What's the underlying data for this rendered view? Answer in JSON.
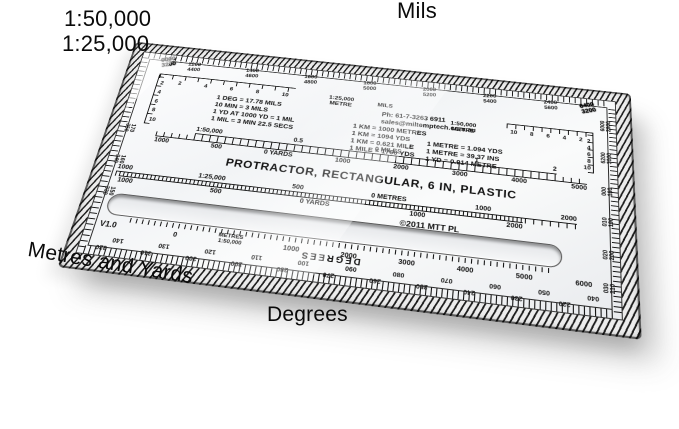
{
  "annotations": {
    "scale_50k": "1:50,000",
    "scale_25k": "1:25,000",
    "mils": "Mils",
    "metres_and_yards": "Metres and Yards",
    "degrees": "Degrees"
  },
  "board": {
    "title": "PROTRACTOR, RECTANGULAR, 6 IN, PLASTIC",
    "copyright": "©2011 MTT PL",
    "version": "V1.0",
    "contact": {
      "phone": "Ph: 61-7-3263 6911",
      "email": "sales@miltemptech.com.au"
    },
    "mils_facts": [
      "1 DEG = 17.78 MILS",
      "10 MIN = 3 MILS",
      "1 YD AT 1000 YD = 1 MIL",
      "1 MIL = 3 MIN 22.5 SECS"
    ],
    "km_facts": [
      "1 KM = 1000 METRES",
      "1 KM = 1094 YDS",
      "1 KM = 0.621 MILE",
      "1 MILE = 1760 YDS"
    ],
    "metre_facts": [
      "1 METRE = 1.094 YDS",
      "1 METRE = 39.37 INS",
      "1 YD = 0.914 METRE"
    ],
    "top_mils_scale": {
      "corner_left": [
        "0000",
        "3200"
      ],
      "corner_right": [
        "6400",
        "3200"
      ],
      "pairs": [
        [
          "1200",
          "4400"
        ],
        [
          "1400",
          "4600"
        ],
        [
          "1600",
          "4800"
        ],
        [
          "1800",
          "5000"
        ],
        [
          "2000",
          "5200"
        ],
        [
          "2200",
          "5400"
        ],
        [
          "2400",
          "5600"
        ]
      ]
    },
    "corner_scale_25k": {
      "label_line1": "1:25,000",
      "label_line2": "METRE",
      "mils_label": "MILS",
      "h_numbers": [
        "2",
        "4",
        "6",
        "8",
        "10"
      ],
      "v_numbers": [
        "2",
        "4",
        "6",
        "8",
        "10"
      ]
    },
    "corner_scale_50k": {
      "label_line1": "1:50,000",
      "label_line2": "METRE",
      "h_numbers": [
        "10",
        "8",
        "6",
        "4",
        "2"
      ],
      "v_numbers": [
        "2",
        "4",
        "6",
        "8",
        "10"
      ]
    },
    "ruler_50k": {
      "miles_row": [
        "1:50,000",
        "0.5",
        "0 MILES",
        "1",
        "2"
      ],
      "yards_row": [
        "1000",
        "500",
        "0 YARDS",
        "1000",
        "2000",
        "3000",
        "4000",
        "5000"
      ]
    },
    "ruler_25k": {
      "metres_row": [
        "1000",
        "1:25,000",
        "500",
        "0 METRES",
        "1000",
        "2000"
      ],
      "yards_row": [
        "1000",
        "500",
        "0 YARDS",
        "1000",
        "2000"
      ]
    },
    "bottom_scale": {
      "items": [
        "0",
        [
          "METRES",
          "1:50,000"
        ],
        "1000",
        "2000",
        "3000",
        "4000",
        "5000",
        "6000"
      ]
    },
    "degrees_label": "DEGREES",
    "bottom_degrees": {
      "outer": [
        "040",
        "050",
        "060",
        "070",
        "080",
        "090",
        "100",
        "110",
        "120",
        "130",
        "140"
      ],
      "inner": [
        "220",
        "230",
        "240",
        "250",
        "260",
        "270",
        "280",
        "290",
        "300",
        "310",
        "320"
      ]
    },
    "left_edge_degrees": [
      [
        "170",
        "350"
      ],
      [
        "160",
        "340"
      ],
      [
        "150",
        "330"
      ]
    ],
    "right_edge_mils": [
      [
        "6000",
        "2800"
      ],
      [
        "6200",
        "3000"
      ]
    ],
    "right_edge_degrees": [
      [
        "000",
        "180"
      ],
      [
        "010",
        "190"
      ],
      [
        "020",
        "200"
      ],
      [
        "030",
        "210"
      ]
    ]
  }
}
